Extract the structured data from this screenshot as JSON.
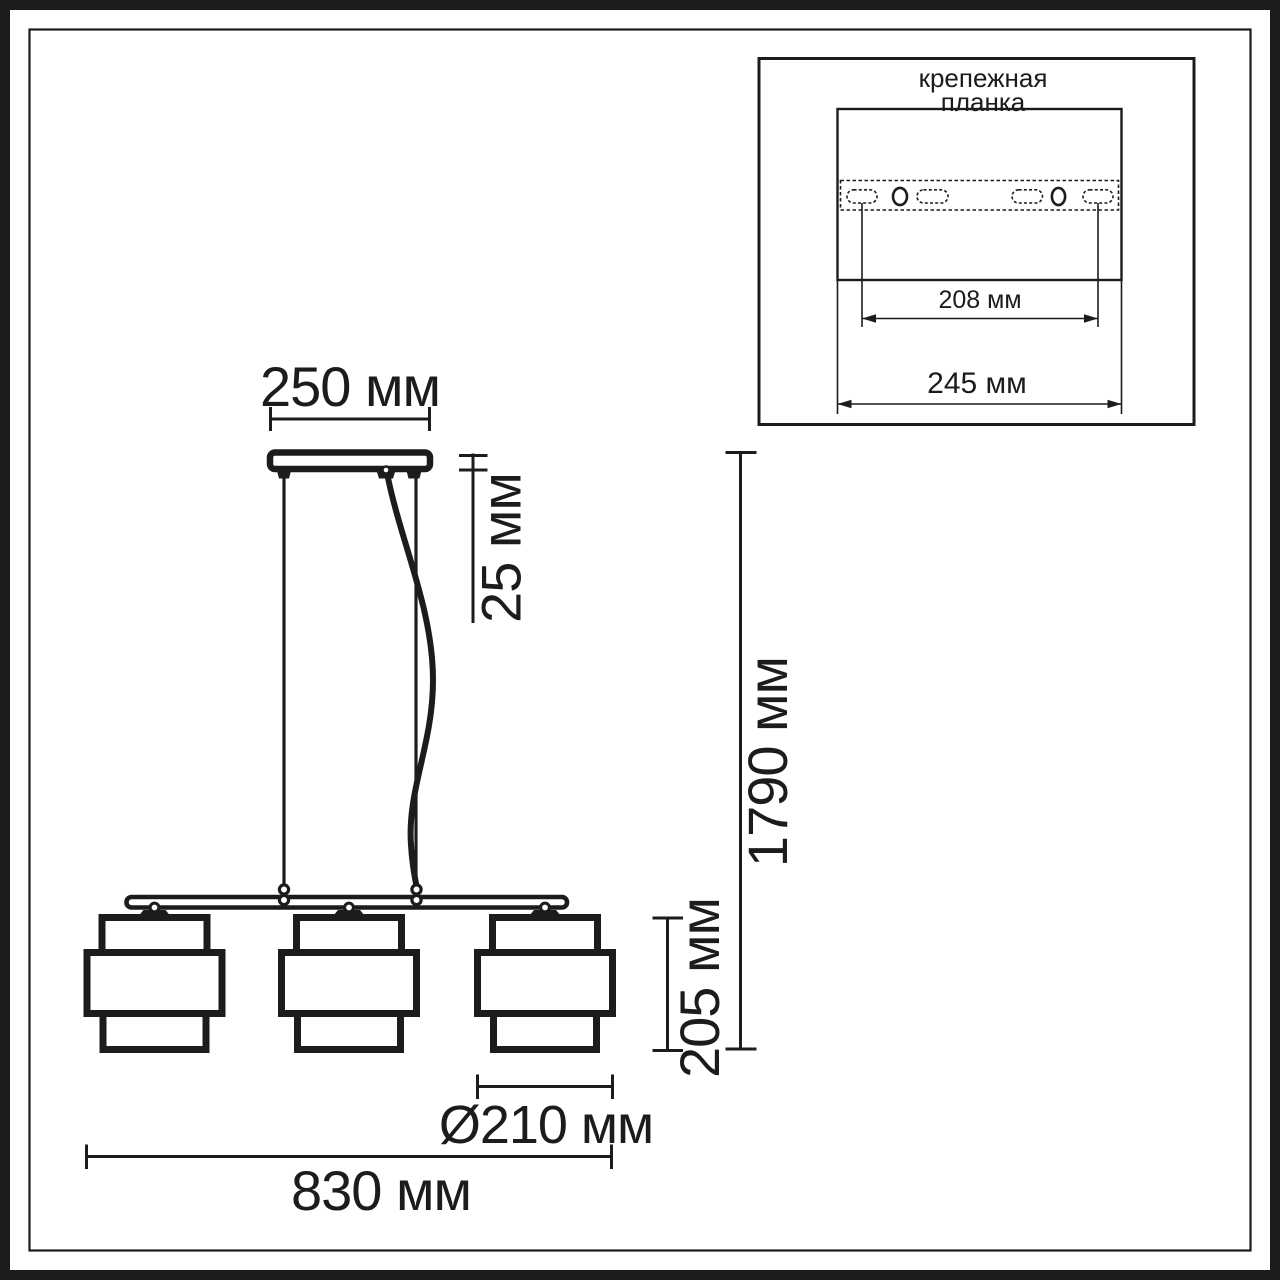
{
  "drawing": {
    "type": "pendant-light-technical-drawing",
    "labels": {
      "canopy_width": "250 мм",
      "canopy_height": "25 мм",
      "overall_height": "1790 мм",
      "shade_height": "205 мм",
      "shade_diameter": "Ø210 мм",
      "overall_width": "830 мм"
    },
    "inset": {
      "title_line1": "крепежная",
      "title_line2": "планка",
      "hole_spacing": "208 мм",
      "plate_width": "245 мм"
    },
    "colors": {
      "line": "#1c1c1c",
      "background": "#ffffff"
    }
  }
}
